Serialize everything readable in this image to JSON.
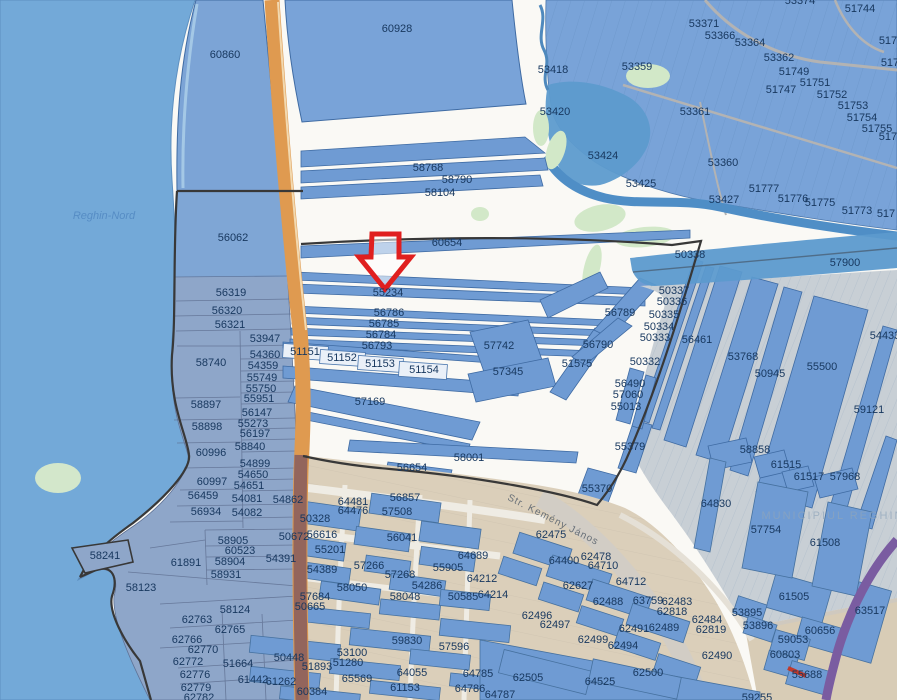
{
  "map": {
    "type": "cadastral-parcel-map-viewer",
    "place_labels": {
      "region": "Reghin-Nord",
      "municipality": "MUNICIPIUL REGHIN",
      "street": "Str. Kemény János"
    },
    "annotation": {
      "kind": "arrow",
      "points_to_parcel": "55234",
      "color": "#e01f1f"
    },
    "colors": {
      "parcel_fill": "#6f9bd3",
      "parcel_stroke": "#3f6ba3",
      "water": "#73a9d8",
      "river": "#4f8ec6",
      "road_orange": "#df9a50",
      "road_purple": "#7a5ca1",
      "urban_tan": "#dbcfba",
      "label_text": "#17375e",
      "survey_outline": "#383838"
    },
    "labels": [
      {
        "t": "60860",
        "x": 225,
        "y": 55
      },
      {
        "t": "60928",
        "x": 397,
        "y": 29
      },
      {
        "t": "53374",
        "x": 800,
        "y": 1
      },
      {
        "t": "51744",
        "x": 860,
        "y": 9
      },
      {
        "t": "53371",
        "x": 704,
        "y": 24
      },
      {
        "t": "53366",
        "x": 720,
        "y": 36
      },
      {
        "t": "53364",
        "x": 750,
        "y": 43
      },
      {
        "t": "53362",
        "x": 779,
        "y": 58
      },
      {
        "t": "51749",
        "x": 794,
        "y": 72
      },
      {
        "t": "51747",
        "x": 781,
        "y": 90
      },
      {
        "t": "51751",
        "x": 815,
        "y": 83
      },
      {
        "t": "51752",
        "x": 832,
        "y": 95
      },
      {
        "t": "51753",
        "x": 853,
        "y": 106
      },
      {
        "t": "51754",
        "x": 862,
        "y": 118
      },
      {
        "t": "51755",
        "x": 877,
        "y": 129
      },
      {
        "t": "517",
        "x": 888,
        "y": 41
      },
      {
        "t": "517",
        "x": 890,
        "y": 63
      },
      {
        "t": "5175",
        "x": 891,
        "y": 137
      },
      {
        "t": "53359",
        "x": 637,
        "y": 67
      },
      {
        "t": "53361",
        "x": 695,
        "y": 112
      },
      {
        "t": "53360",
        "x": 723,
        "y": 163
      },
      {
        "t": "53427",
        "x": 724,
        "y": 200
      },
      {
        "t": "51777",
        "x": 764,
        "y": 189
      },
      {
        "t": "51776",
        "x": 793,
        "y": 199
      },
      {
        "t": "51775",
        "x": 820,
        "y": 203
      },
      {
        "t": "51773",
        "x": 857,
        "y": 211
      },
      {
        "t": "517",
        "x": 886,
        "y": 214
      },
      {
        "t": "53418",
        "x": 553,
        "y": 70
      },
      {
        "t": "53420",
        "x": 555,
        "y": 112
      },
      {
        "t": "53424",
        "x": 603,
        "y": 156
      },
      {
        "t": "53425",
        "x": 641,
        "y": 184
      },
      {
        "t": "58768",
        "x": 428,
        "y": 168
      },
      {
        "t": "58790",
        "x": 457,
        "y": 180
      },
      {
        "t": "58104",
        "x": 440,
        "y": 193
      },
      {
        "t": "60654",
        "x": 447,
        "y": 243
      },
      {
        "t": "55234",
        "x": 388,
        "y": 293
      },
      {
        "t": "56786",
        "x": 389,
        "y": 313
      },
      {
        "t": "56785",
        "x": 384,
        "y": 324
      },
      {
        "t": "56784",
        "x": 381,
        "y": 335
      },
      {
        "t": "56793",
        "x": 377,
        "y": 346
      },
      {
        "t": "51151",
        "x": 305,
        "y": 352
      },
      {
        "t": "51152",
        "x": 342,
        "y": 358
      },
      {
        "t": "51153",
        "x": 380,
        "y": 364
      },
      {
        "t": "51154",
        "x": 424,
        "y": 370
      },
      {
        "t": "57169",
        "x": 370,
        "y": 402
      },
      {
        "t": "57742",
        "x": 499,
        "y": 346
      },
      {
        "t": "57345",
        "x": 508,
        "y": 372
      },
      {
        "t": "51575",
        "x": 577,
        "y": 364
      },
      {
        "t": "56789",
        "x": 620,
        "y": 313
      },
      {
        "t": "56790",
        "x": 598,
        "y": 345
      },
      {
        "t": "58001",
        "x": 469,
        "y": 458
      },
      {
        "t": "56654",
        "x": 412,
        "y": 468
      },
      {
        "t": "55370",
        "x": 597,
        "y": 489
      },
      {
        "t": "56062",
        "x": 233,
        "y": 238
      },
      {
        "t": "56319",
        "x": 231,
        "y": 293
      },
      {
        "t": "56320",
        "x": 227,
        "y": 311
      },
      {
        "t": "56321",
        "x": 230,
        "y": 325
      },
      {
        "t": "53947",
        "x": 265,
        "y": 339
      },
      {
        "t": "54360",
        "x": 265,
        "y": 355
      },
      {
        "t": "54359",
        "x": 263,
        "y": 366
      },
      {
        "t": "55749",
        "x": 262,
        "y": 378
      },
      {
        "t": "55750",
        "x": 261,
        "y": 389
      },
      {
        "t": "55951",
        "x": 259,
        "y": 399
      },
      {
        "t": "58740",
        "x": 211,
        "y": 363
      },
      {
        "t": "58897",
        "x": 206,
        "y": 405
      },
      {
        "t": "56147",
        "x": 257,
        "y": 413
      },
      {
        "t": "55273",
        "x": 253,
        "y": 424
      },
      {
        "t": "58898",
        "x": 207,
        "y": 427
      },
      {
        "t": "56197",
        "x": 255,
        "y": 434
      },
      {
        "t": "58840",
        "x": 250,
        "y": 447
      },
      {
        "t": "60996",
        "x": 211,
        "y": 453
      },
      {
        "t": "54899",
        "x": 255,
        "y": 464
      },
      {
        "t": "54650",
        "x": 253,
        "y": 475
      },
      {
        "t": "60997",
        "x": 212,
        "y": 482
      },
      {
        "t": "54651",
        "x": 249,
        "y": 486
      },
      {
        "t": "56459",
        "x": 203,
        "y": 496
      },
      {
        "t": "54081",
        "x": 247,
        "y": 499
      },
      {
        "t": "54862",
        "x": 288,
        "y": 500
      },
      {
        "t": "56934",
        "x": 206,
        "y": 512
      },
      {
        "t": "54082",
        "x": 247,
        "y": 513
      },
      {
        "t": "58905",
        "x": 233,
        "y": 541
      },
      {
        "t": "60523",
        "x": 240,
        "y": 551
      },
      {
        "t": "58904",
        "x": 230,
        "y": 562
      },
      {
        "t": "58931",
        "x": 226,
        "y": 575
      },
      {
        "t": "61891",
        "x": 186,
        "y": 563
      },
      {
        "t": "58241",
        "x": 105,
        "y": 556
      },
      {
        "t": "58123",
        "x": 141,
        "y": 588
      },
      {
        "t": "58124",
        "x": 235,
        "y": 610
      },
      {
        "t": "62763",
        "x": 197,
        "y": 620
      },
      {
        "t": "62765",
        "x": 230,
        "y": 630
      },
      {
        "t": "62766",
        "x": 187,
        "y": 640
      },
      {
        "t": "62770",
        "x": 203,
        "y": 650
      },
      {
        "t": "62772",
        "x": 188,
        "y": 662
      },
      {
        "t": "51664",
        "x": 238,
        "y": 664
      },
      {
        "t": "62776",
        "x": 195,
        "y": 675
      },
      {
        "t": "61442",
        "x": 253,
        "y": 680
      },
      {
        "t": "61262",
        "x": 281,
        "y": 682
      },
      {
        "t": "62779",
        "x": 196,
        "y": 688
      },
      {
        "t": "62782",
        "x": 199,
        "y": 698
      },
      {
        "t": "50328",
        "x": 315,
        "y": 519
      },
      {
        "t": "64481",
        "x": 353,
        "y": 502
      },
      {
        "t": "64476",
        "x": 353,
        "y": 511
      },
      {
        "t": "56857",
        "x": 405,
        "y": 498
      },
      {
        "t": "57508",
        "x": 397,
        "y": 512
      },
      {
        "t": "50672",
        "x": 294,
        "y": 537
      },
      {
        "t": "56616",
        "x": 322,
        "y": 535
      },
      {
        "t": "56041",
        "x": 402,
        "y": 538
      },
      {
        "t": "55201",
        "x": 330,
        "y": 550
      },
      {
        "t": "54391",
        "x": 281,
        "y": 559
      },
      {
        "t": "54389",
        "x": 322,
        "y": 570
      },
      {
        "t": "57266",
        "x": 369,
        "y": 566
      },
      {
        "t": "57268",
        "x": 400,
        "y": 575
      },
      {
        "t": "58050",
        "x": 352,
        "y": 588
      },
      {
        "t": "54286",
        "x": 427,
        "y": 586
      },
      {
        "t": "58048",
        "x": 405,
        "y": 597
      },
      {
        "t": "50585",
        "x": 463,
        "y": 597
      },
      {
        "t": "55905",
        "x": 448,
        "y": 568
      },
      {
        "t": "64689",
        "x": 473,
        "y": 556
      },
      {
        "t": "64212",
        "x": 482,
        "y": 579
      },
      {
        "t": "64214",
        "x": 493,
        "y": 595
      },
      {
        "t": "57684",
        "x": 315,
        "y": 597
      },
      {
        "t": "50665",
        "x": 310,
        "y": 607
      },
      {
        "t": "59830",
        "x": 407,
        "y": 641
      },
      {
        "t": "57596",
        "x": 454,
        "y": 647
      },
      {
        "t": "53100",
        "x": 352,
        "y": 653
      },
      {
        "t": "51280",
        "x": 348,
        "y": 663
      },
      {
        "t": "50448",
        "x": 289,
        "y": 658
      },
      {
        "t": "51893",
        "x": 317,
        "y": 667
      },
      {
        "t": "65569",
        "x": 357,
        "y": 679
      },
      {
        "t": "64055",
        "x": 412,
        "y": 673
      },
      {
        "t": "61153",
        "x": 405,
        "y": 688
      },
      {
        "t": "60384",
        "x": 312,
        "y": 692
      },
      {
        "t": "50338",
        "x": 690,
        "y": 255
      },
      {
        "t": "57900",
        "x": 845,
        "y": 263
      },
      {
        "t": "50337",
        "x": 674,
        "y": 291
      },
      {
        "t": "50336",
        "x": 672,
        "y": 302
      },
      {
        "t": "50335",
        "x": 664,
        "y": 315
      },
      {
        "t": "50334",
        "x": 659,
        "y": 327
      },
      {
        "t": "50333",
        "x": 655,
        "y": 338
      },
      {
        "t": "50332",
        "x": 645,
        "y": 362
      },
      {
        "t": "56461",
        "x": 697,
        "y": 340
      },
      {
        "t": "53768",
        "x": 743,
        "y": 357
      },
      {
        "t": "50945",
        "x": 770,
        "y": 374
      },
      {
        "t": "55500",
        "x": 822,
        "y": 367
      },
      {
        "t": "54433",
        "x": 885,
        "y": 336
      },
      {
        "t": "59121",
        "x": 869,
        "y": 410
      },
      {
        "t": "56490",
        "x": 630,
        "y": 384
      },
      {
        "t": "57060",
        "x": 628,
        "y": 395
      },
      {
        "t": "55013",
        "x": 626,
        "y": 407
      },
      {
        "t": "55379",
        "x": 630,
        "y": 447
      },
      {
        "t": "58858",
        "x": 755,
        "y": 450
      },
      {
        "t": "61515",
        "x": 786,
        "y": 465
      },
      {
        "t": "61517",
        "x": 809,
        "y": 477
      },
      {
        "t": "57968",
        "x": 845,
        "y": 477
      },
      {
        "t": "64830",
        "x": 716,
        "y": 504
      },
      {
        "t": "57754",
        "x": 766,
        "y": 530
      },
      {
        "t": "61508",
        "x": 825,
        "y": 543
      },
      {
        "t": "62475",
        "x": 551,
        "y": 535
      },
      {
        "t": "64400",
        "x": 564,
        "y": 561
      },
      {
        "t": "62478",
        "x": 596,
        "y": 557
      },
      {
        "t": "64710",
        "x": 603,
        "y": 566
      },
      {
        "t": "64712",
        "x": 631,
        "y": 582
      },
      {
        "t": "62627",
        "x": 578,
        "y": 586
      },
      {
        "t": "62488",
        "x": 608,
        "y": 602
      },
      {
        "t": "63759",
        "x": 648,
        "y": 601
      },
      {
        "t": "62483",
        "x": 677,
        "y": 602
      },
      {
        "t": "62818",
        "x": 672,
        "y": 612
      },
      {
        "t": "62484",
        "x": 707,
        "y": 620
      },
      {
        "t": "62491",
        "x": 634,
        "y": 629
      },
      {
        "t": "62489",
        "x": 664,
        "y": 628
      },
      {
        "t": "62819",
        "x": 711,
        "y": 630
      },
      {
        "t": "62494",
        "x": 623,
        "y": 646
      },
      {
        "t": "62499",
        "x": 593,
        "y": 640
      },
      {
        "t": "62496",
        "x": 537,
        "y": 616
      },
      {
        "t": "62497",
        "x": 555,
        "y": 625
      },
      {
        "t": "62490",
        "x": 717,
        "y": 656
      },
      {
        "t": "62500",
        "x": 648,
        "y": 673
      },
      {
        "t": "64525",
        "x": 600,
        "y": 682
      },
      {
        "t": "62505",
        "x": 528,
        "y": 678
      },
      {
        "t": "64785",
        "x": 478,
        "y": 674
      },
      {
        "t": "64786",
        "x": 470,
        "y": 689
      },
      {
        "t": "64787",
        "x": 500,
        "y": 695
      },
      {
        "t": "53895",
        "x": 747,
        "y": 613
      },
      {
        "t": "53896",
        "x": 758,
        "y": 626
      },
      {
        "t": "61505",
        "x": 794,
        "y": 597
      },
      {
        "t": "63517",
        "x": 870,
        "y": 611
      },
      {
        "t": "60656",
        "x": 820,
        "y": 631
      },
      {
        "t": "59053",
        "x": 793,
        "y": 640
      },
      {
        "t": "60803",
        "x": 785,
        "y": 655
      },
      {
        "t": "55688",
        "x": 807,
        "y": 675
      },
      {
        "t": "59255",
        "x": 757,
        "y": 698
      },
      {
        "t": "Reghin-Nord",
        "x": 104,
        "y": 216,
        "cls": "water-name"
      },
      {
        "t": "MUNICIPIUL REGHIN",
        "x": 833,
        "y": 516,
        "cls": "muni"
      },
      {
        "t": "Str. Kemény János",
        "x": 553,
        "y": 520,
        "cls": "street",
        "rot": 27
      }
    ]
  }
}
